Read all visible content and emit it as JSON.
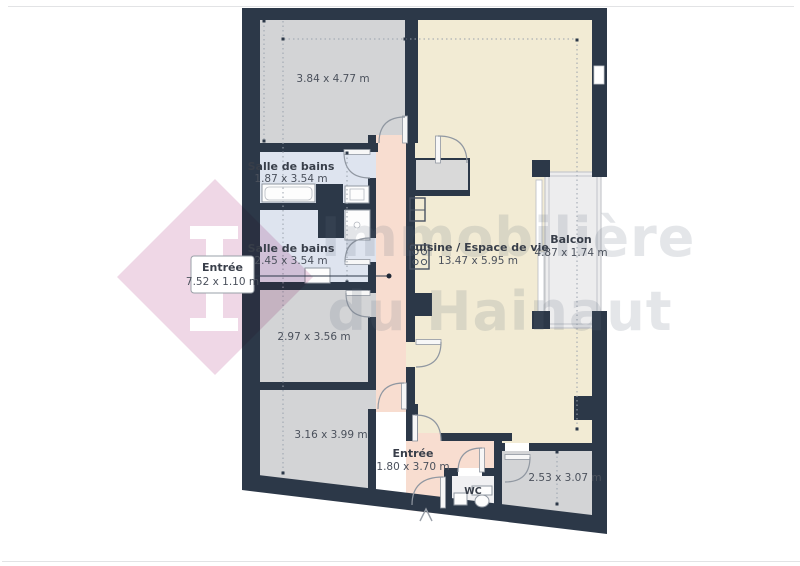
{
  "plan": {
    "rooms": {
      "bedroom1": {
        "dims": "3.84 x 4.77 m"
      },
      "bathroom1": {
        "name": "Salle de bains",
        "dims": "1.87 x 3.54 m"
      },
      "bathroom2": {
        "name": "Salle de bains",
        "dims": "2.45 x 3.54 m"
      },
      "room297": {
        "dims": "2.97 x 3.56 m"
      },
      "room316": {
        "dims": "3.16 x 3.99 m"
      },
      "kitchen": {
        "name": "Cuisine / Espace de vie",
        "dims": "13.47 x 5.95 m"
      },
      "balcony": {
        "name": "Balcon",
        "dims": "4.87 x 1.74 m"
      },
      "hall": {
        "name": "Entrée",
        "dims": "1.80 x 3.70 m"
      },
      "wc": {
        "name": "WC"
      },
      "room253": {
        "dims": "2.53 x 3.07 m"
      }
    },
    "callout": {
      "name": "Entrée",
      "dims": "7.52 x 1.10 m"
    },
    "watermark": {
      "line1": "Immobilière",
      "line2": "du Hainaut"
    },
    "colors": {
      "wall": "#2c3848",
      "room_gray": "#d3d4d6",
      "bathroom": "#dee4ef",
      "kitchen": "#f2ebd4",
      "corridor": "#f8ddd0",
      "balcony": "#ededee",
      "wc_floor": "#f0f0f2",
      "watermark": "#5f6b7d",
      "logo_pink": "#eed3e4",
      "frame_line": "#e2e3e5",
      "callout_line": "#2c3848"
    }
  }
}
